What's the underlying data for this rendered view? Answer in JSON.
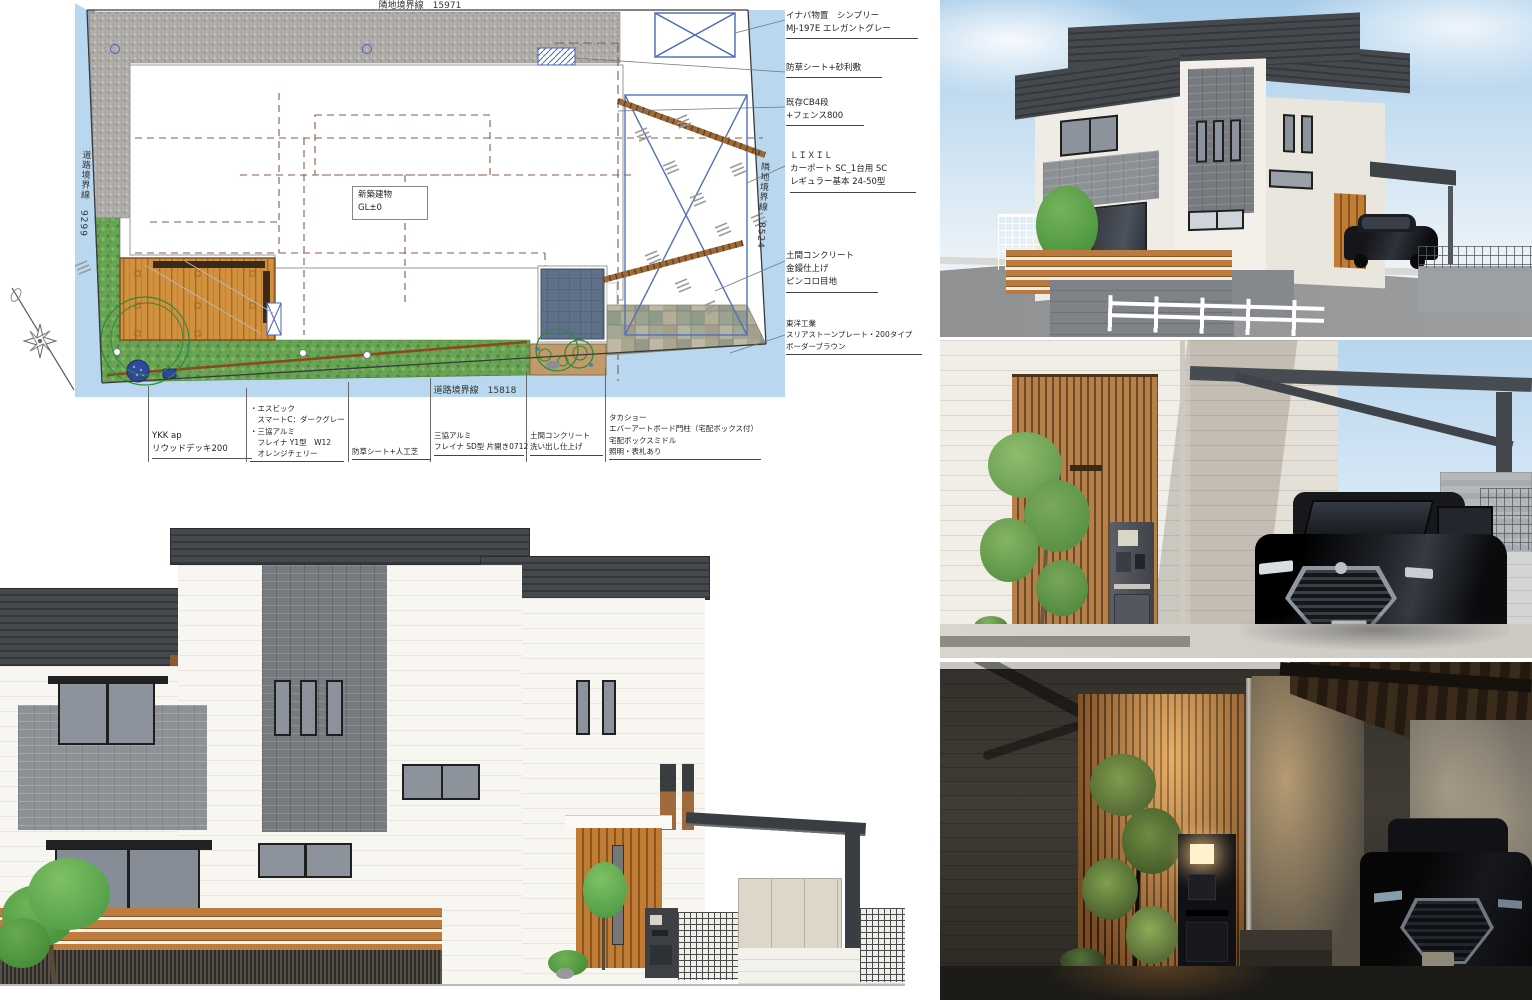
{
  "site_plan": {
    "boundaries": {
      "top": "隣地境界線　15971",
      "left": "道路境界線　9299",
      "right": "隣地境界線　8524",
      "bottom": "道路境界線　15818"
    },
    "building_label": {
      "line1": "新築建物",
      "line2": "GL±0"
    },
    "annotations_right": [
      {
        "lines": [
          "イナバ物置　シンプリー",
          "MJ-197E エレガントグレー"
        ]
      },
      {
        "lines": [
          "防草シート+砂利敷"
        ]
      },
      {
        "lines": [
          "既存CB4段",
          "+フェンス800"
        ]
      },
      {
        "lines": [
          "ＬＩＸＩＬ",
          "カーポート SC_1台用 SC",
          "レギュラー基本 24-50型"
        ]
      },
      {
        "lines": [
          "土間コンクリート",
          "金鏝仕上げ",
          "ピンコロ目地"
        ]
      },
      {
        "lines": [
          "東洋工業",
          "スリアストーンプレート・200タイプ",
          "ボーダーブラウン"
        ]
      }
    ],
    "annotations_bottom": [
      {
        "lines": [
          "YKK ap",
          "リウッドデッキ200"
        ]
      },
      {
        "lines": [
          "・エスビック",
          "　スマートC：ダークグレー",
          "・三協アルミ",
          "　フレイナ Y1型　W12",
          "　オレンジチェリー"
        ]
      },
      {
        "lines": [
          "防草シート+人工芝"
        ]
      },
      {
        "lines": [
          "三協アルミ",
          "フレイナ SD型 片開き0712"
        ]
      },
      {
        "lines": [
          "土間コンクリート",
          "洗い出し仕上げ"
        ]
      },
      {
        "lines": [
          "タカショー",
          "エバーアートボード門柱（宅配ボックス付）",
          "宅配ボックスミドル",
          "照明・表札あり"
        ]
      }
    ],
    "colors": {
      "road_blue": "#b9d8ef",
      "lawn_green": "#69a455",
      "deck_wood": "#d2913f",
      "patio_tile": "#5f7088",
      "carport_line": "#5570bb"
    }
  }
}
